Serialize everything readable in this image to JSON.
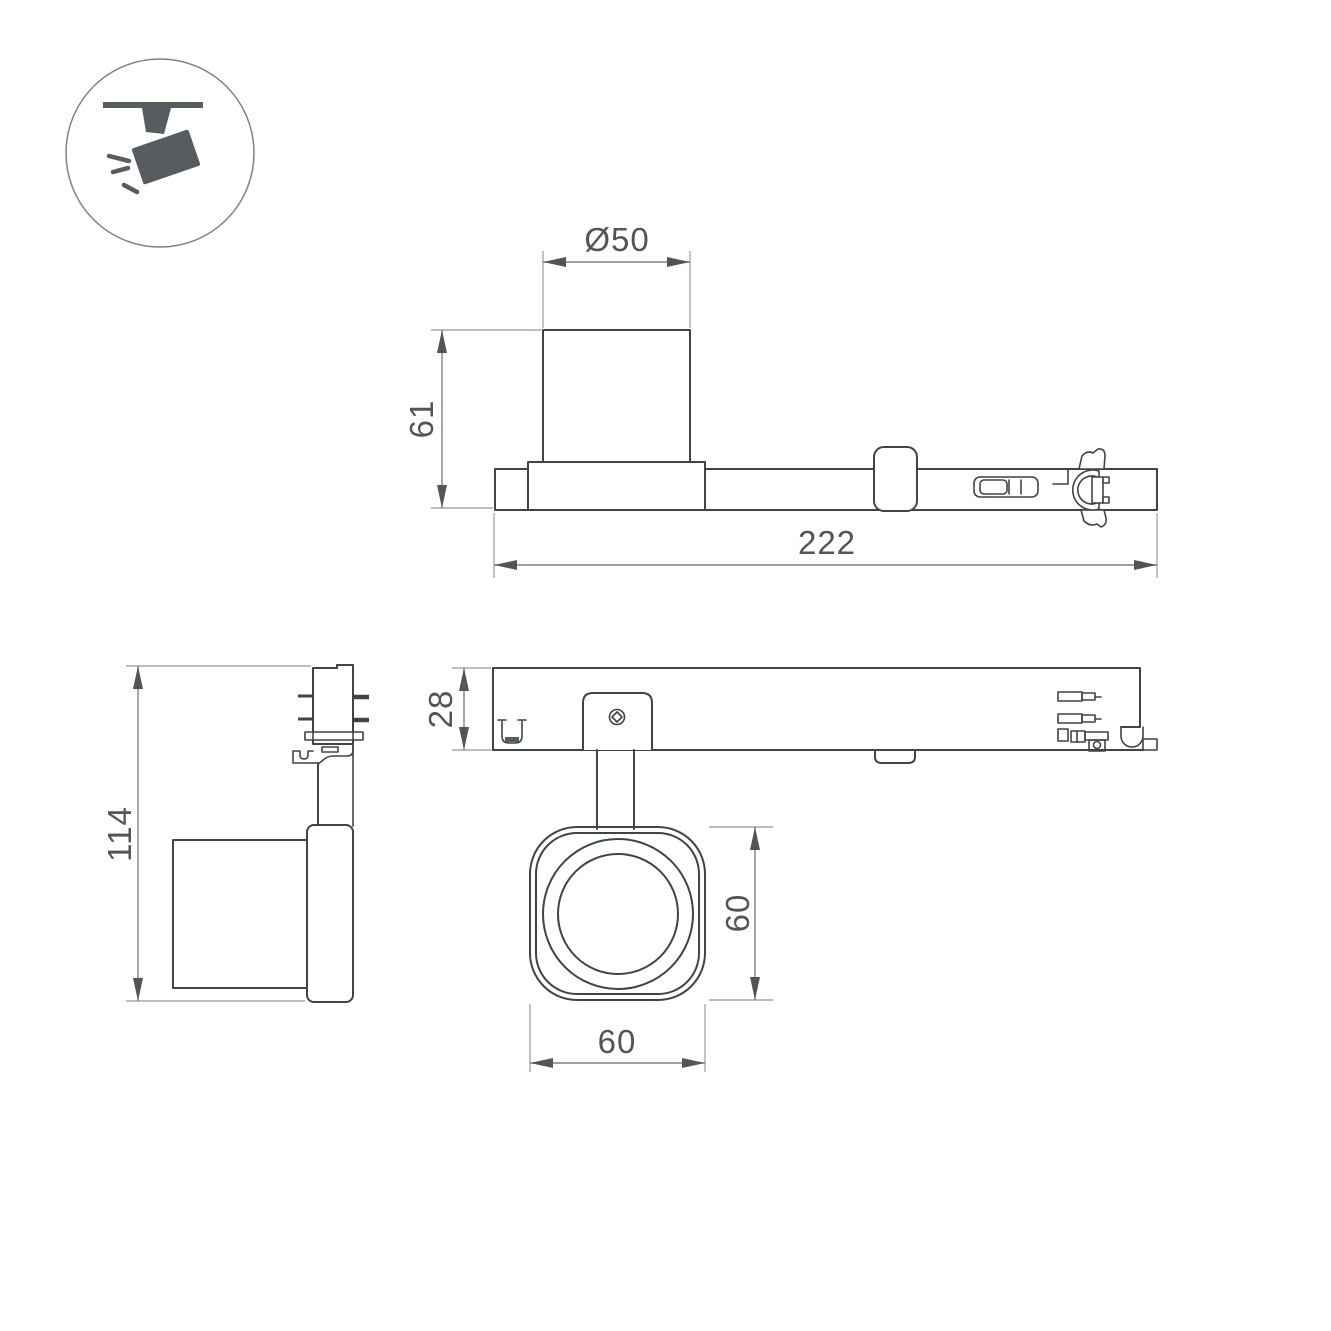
{
  "colors": {
    "background": "#ffffff",
    "line": "#3f4448",
    "dimension_text": "#515558",
    "dimension_line": "#7d8286",
    "extension_line": "#a6aaae",
    "icon": "#575c60"
  },
  "icon": {
    "name": "ceiling-track-spotlight"
  },
  "views": {
    "side": {
      "diameter_label": "Ø50",
      "height_label": "61",
      "length_label": "222"
    },
    "front": {
      "height_label": "114"
    },
    "bottom": {
      "profile_height_label": "28",
      "head_height_label": "60",
      "head_width_label": "60"
    }
  }
}
